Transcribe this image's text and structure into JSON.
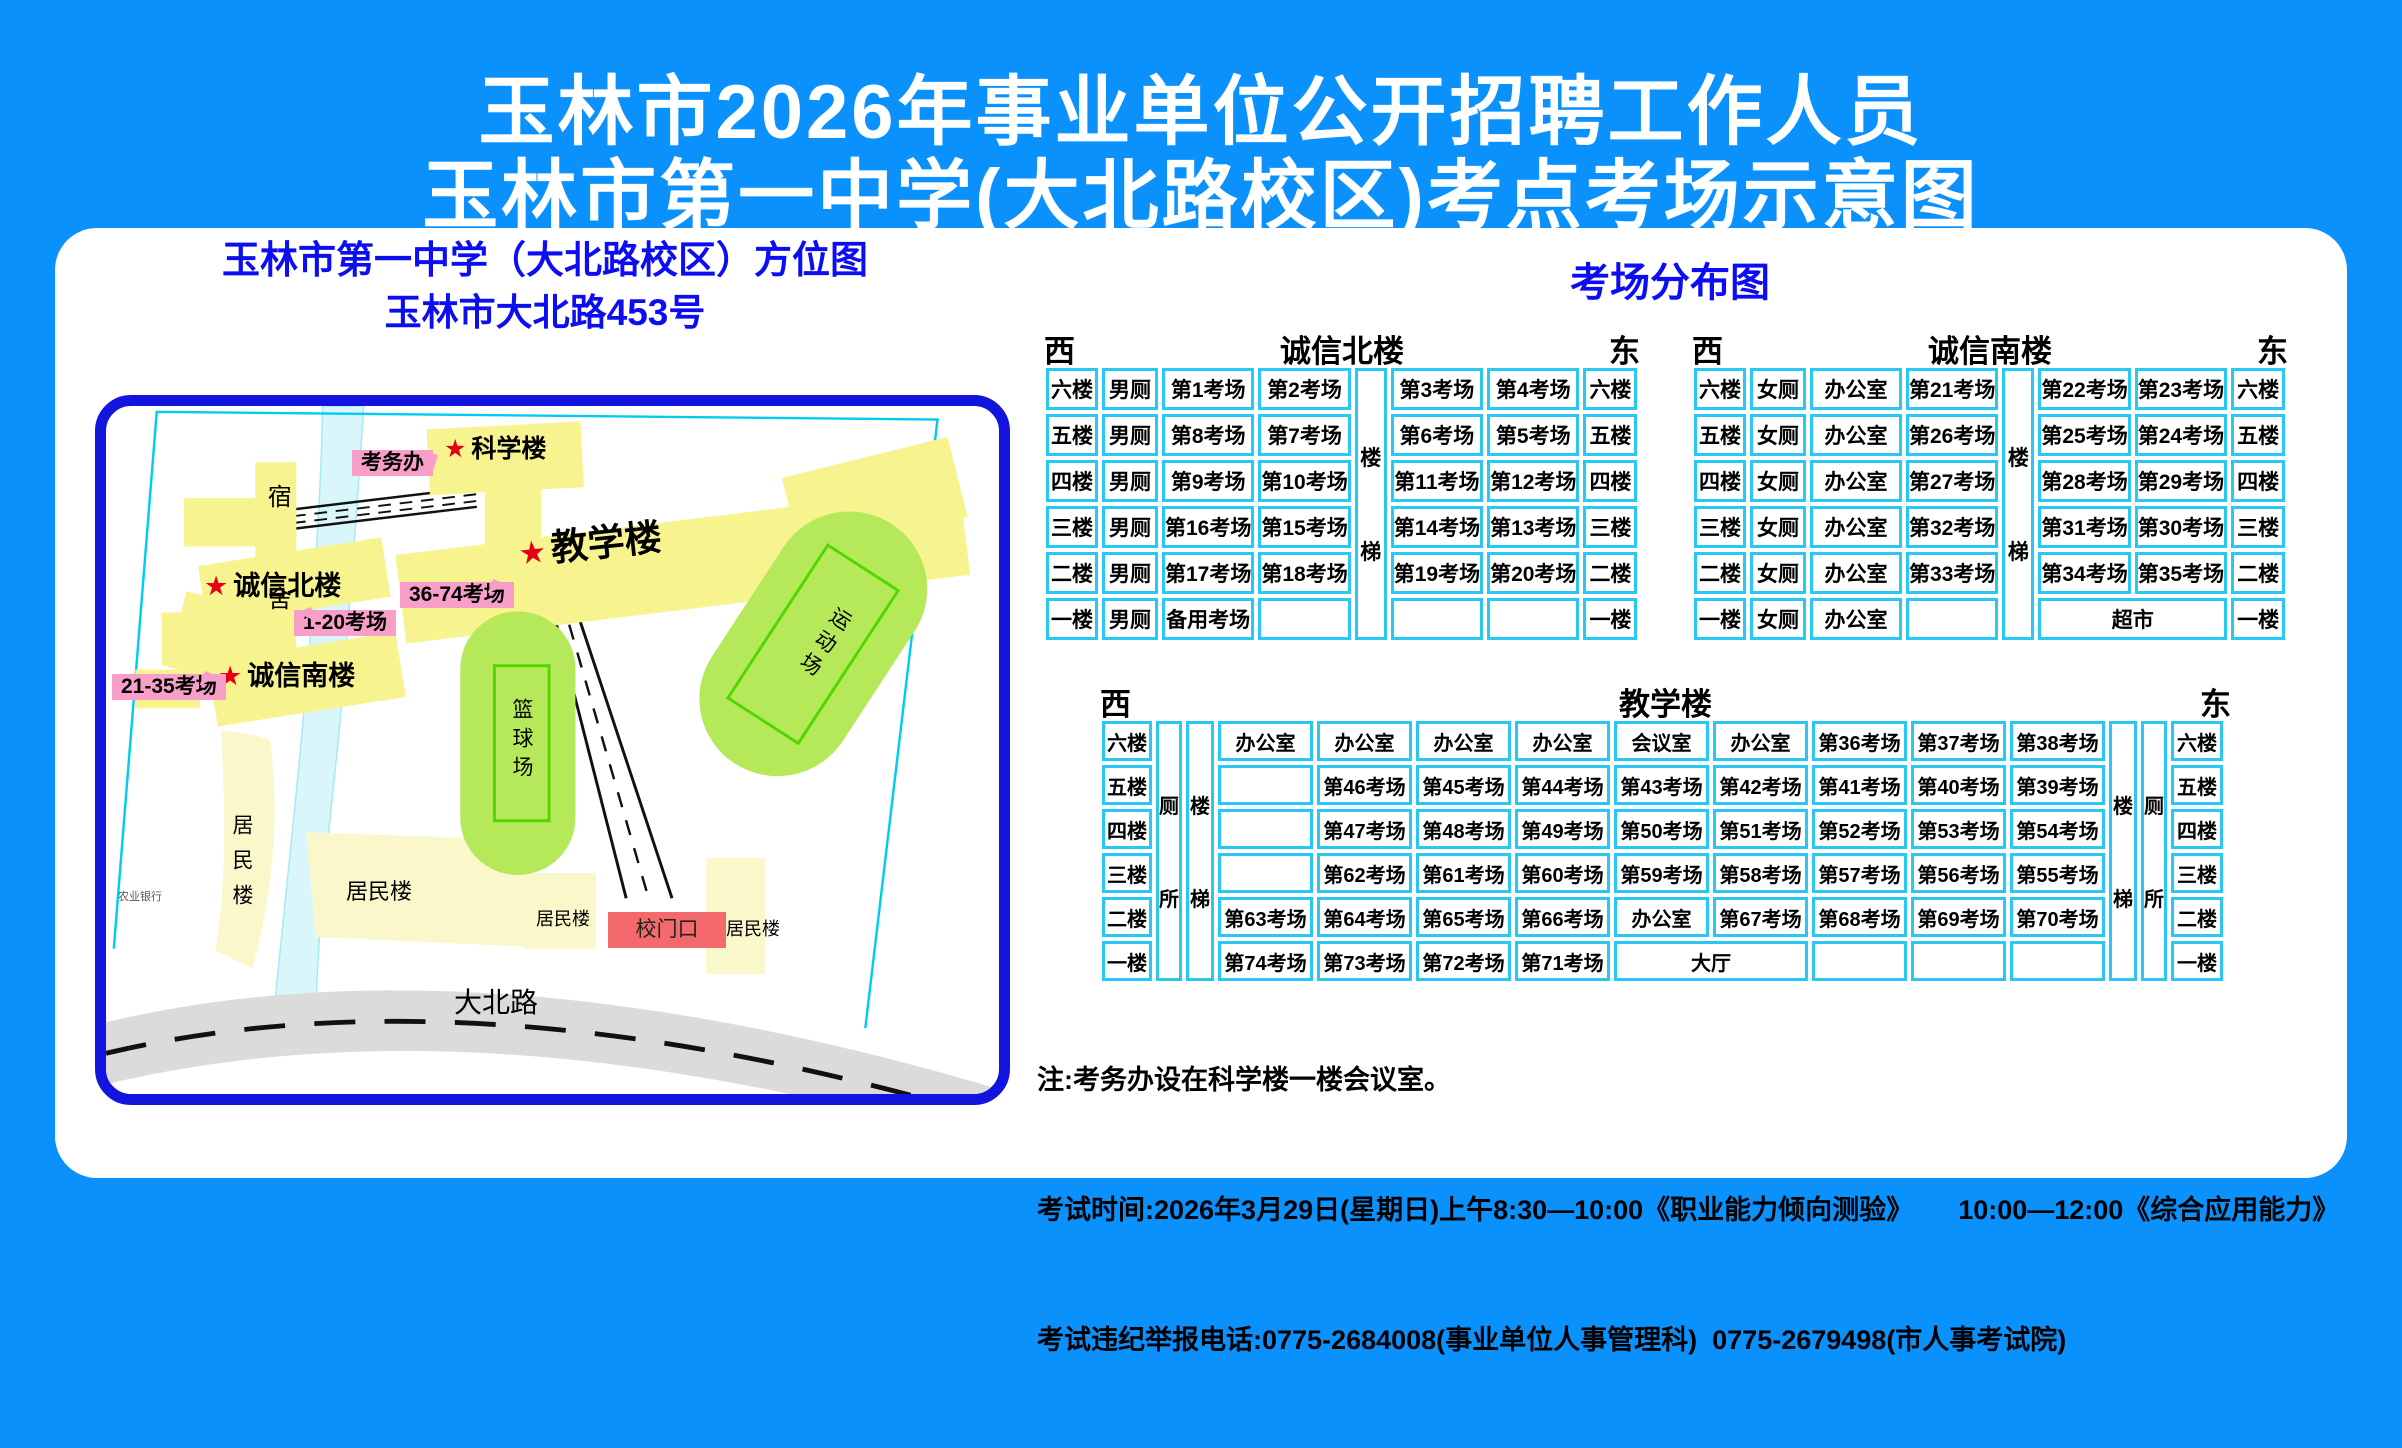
{
  "page": {
    "bg": "#0A91FB",
    "accent_blue": "#0D0DF2",
    "table_border": "#29C8F2",
    "pink": "#F89FC9",
    "gate_red": "#F4696B",
    "star_red": "#E60012"
  },
  "title": {
    "line1": "玉林市2026年事业单位公开招聘工作人员",
    "line2": "玉林市第一中学(大北路校区)考点考场示意图"
  },
  "map": {
    "heading1": "玉林市第一中学（大北路校区）方位图",
    "heading2": "玉林市大北路453号",
    "star": "★",
    "labels": {
      "dorm": "宿舍",
      "exam_office": "考务办",
      "science": "科学楼",
      "teaching": "教学楼",
      "chengxin_north": "诚信北楼",
      "chengxin_south": "诚信南楼",
      "rooms_1_20": "1-20考场",
      "rooms_21_35": "21-35考场",
      "rooms_36_74": "36-74考场",
      "residential_left": "居民楼",
      "residential_mid": "居民楼",
      "residential_gate_left": "居民楼",
      "residential_gate_right": "居民楼",
      "basketball": "篮球场",
      "sports": "运动场",
      "gate": "校门口",
      "road": "大北路",
      "bank": "农业银行"
    }
  },
  "distribution": {
    "heading": "考场分布图",
    "tables": [
      {
        "key": "chengxin-north",
        "name": "诚信北楼",
        "west": "西",
        "east": "东",
        "x": 987,
        "y": 98,
        "w": 600,
        "cls": "",
        "col_widths": [
          52,
          56,
          92,
          92,
          32,
          92,
          92,
          54
        ],
        "rows": [
          [
            "六楼",
            "男厕",
            "第1考场",
            "第2考场",
            {
              "t": "楼梯",
              "rs": 6,
              "cls": "vcell"
            },
            "第3考场",
            "第4考场",
            "六楼"
          ],
          [
            "五楼",
            "男厕",
            "第8考场",
            "第7考场",
            "第6考场",
            "第5考场",
            "五楼"
          ],
          [
            "四楼",
            "男厕",
            "第9考场",
            "第10考场",
            "第11考场",
            "第12考场",
            "四楼"
          ],
          [
            "三楼",
            "男厕",
            "第16考场",
            "第15考场",
            "第14考场",
            "第13考场",
            "三楼"
          ],
          [
            "二楼",
            "男厕",
            "第17考场",
            "第18考场",
            "第19考场",
            "第20考场",
            "二楼"
          ],
          [
            "一楼",
            "男厕",
            "备用考场",
            "",
            "",
            "",
            "一楼"
          ]
        ]
      },
      {
        "key": "chengxin-south",
        "name": "诚信南楼",
        "west": "西",
        "east": "东",
        "x": 1635,
        "y": 98,
        "w": 600,
        "cls": "",
        "col_widths": [
          52,
          56,
          92,
          92,
          32,
          92,
          92,
          54
        ],
        "rows": [
          [
            "六楼",
            "女厕",
            "办公室",
            "第21考场",
            {
              "t": "楼梯",
              "rs": 6,
              "cls": "vcell"
            },
            "第22考场",
            "第23考场",
            "六楼"
          ],
          [
            "五楼",
            "女厕",
            "办公室",
            "第26考场",
            "第25考场",
            "第24考场",
            "五楼"
          ],
          [
            "四楼",
            "女厕",
            "办公室",
            "第27考场",
            "第28考场",
            "第29考场",
            "四楼"
          ],
          [
            "三楼",
            "女厕",
            "办公室",
            "第32考场",
            "第31考场",
            "第30考场",
            "三楼"
          ],
          [
            "二楼",
            "女厕",
            "办公室",
            "第33考场",
            "第34考场",
            "第35考场",
            "二楼"
          ],
          [
            "一楼",
            "女厕",
            "办公室",
            "",
            {
              "t": "超市",
              "cs": 2
            },
            "一楼"
          ]
        ]
      },
      {
        "key": "teaching",
        "name": "教学楼",
        "west": "西",
        "east": "东",
        "x": 1043,
        "y": 451,
        "w": 1135,
        "cls": "big",
        "col_widths": [
          50,
          26,
          28,
          95,
          95,
          95,
          95,
          95,
          95,
          95,
          95,
          95,
          28,
          26,
          52
        ],
        "rows": [
          [
            "六楼",
            {
              "t": "厕所",
              "rs": 6,
              "cls": "vcell"
            },
            {
              "t": "楼梯",
              "rs": 6,
              "cls": "vcell"
            },
            "办公室",
            "办公室",
            "办公室",
            "办公室",
            "会议室",
            "办公室",
            "第36考场",
            "第37考场",
            "第38考场",
            {
              "t": "楼梯",
              "rs": 6,
              "cls": "vcell"
            },
            {
              "t": "厕所",
              "rs": 6,
              "cls": "vcell"
            },
            "六楼"
          ],
          [
            "五楼",
            "",
            "第46考场",
            "第45考场",
            "第44考场",
            "第43考场",
            "第42考场",
            "第41考场",
            "第40考场",
            "第39考场",
            "五楼"
          ],
          [
            "四楼",
            "",
            "第47考场",
            "第48考场",
            "第49考场",
            "第50考场",
            "第51考场",
            "第52考场",
            "第53考场",
            "第54考场",
            "四楼"
          ],
          [
            "三楼",
            "",
            "第62考场",
            "第61考场",
            "第60考场",
            "第59考场",
            "第58考场",
            "第57考场",
            "第56考场",
            "第55考场",
            "三楼"
          ],
          [
            "二楼",
            "第63考场",
            "第64考场",
            "第65考场",
            "第66考场",
            "办公室",
            "第67考场",
            "第68考场",
            "第69考场",
            "第70考场",
            "二楼"
          ],
          [
            "一楼",
            "第74考场",
            "第73考场",
            "第72考场",
            "第71考场",
            {
              "t": "大厅",
              "cs": 2
            },
            "",
            "",
            "",
            "一楼"
          ]
        ]
      }
    ]
  },
  "notes": {
    "line1": "注:考务办设在科学楼一楼会议室。",
    "line2": "考试时间:2026年3月29日(星期日)上午8:30—10:00《职业能力倾向测验》      10:00—12:00《综合应用能力》",
    "line3": "考试违纪举报电话:0775-2684008(事业单位人事管理科)  0775-2679498(市人事考试院)"
  }
}
